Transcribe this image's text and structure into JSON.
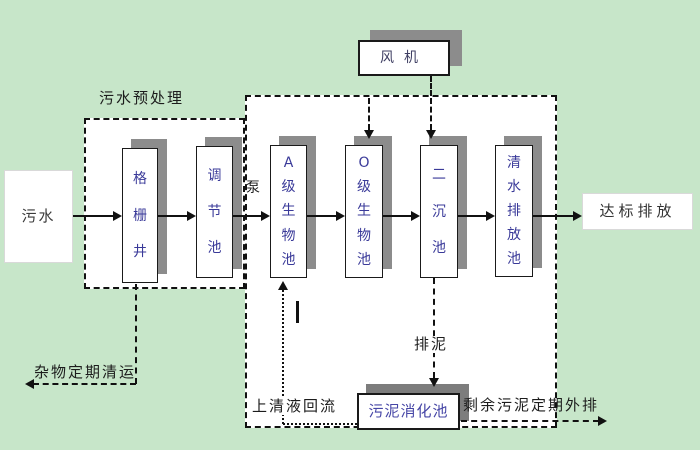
{
  "colors": {
    "background": "#c7e6c9",
    "region_fill": "#ffffff",
    "line": "#111111",
    "tank_text": "#3a3a99",
    "digester_text": "#4646a6",
    "fan_text": "#3f3f63",
    "label_text": "#1c1c1c",
    "shadow": "#8c8c8c"
  },
  "diagram": {
    "influent": "污水",
    "effluent": "达标排放",
    "pretreatment_label": "污水预处理",
    "pump": "泵",
    "fan": "风机",
    "tanks": [
      {
        "label": "格栅井"
      },
      {
        "label": "调节池"
      },
      {
        "label": "A级生物池"
      },
      {
        "label": "O级生物池"
      },
      {
        "label": "二沉池"
      },
      {
        "label": "清水排放池"
      }
    ],
    "digester": "污泥消化池",
    "annotations": {
      "debris_removal": "杂物定期清运",
      "supernatant_return": "上清液回流",
      "sludge_discharge": "排泥",
      "excess_sludge_out": "剩余污泥定期外排"
    }
  }
}
